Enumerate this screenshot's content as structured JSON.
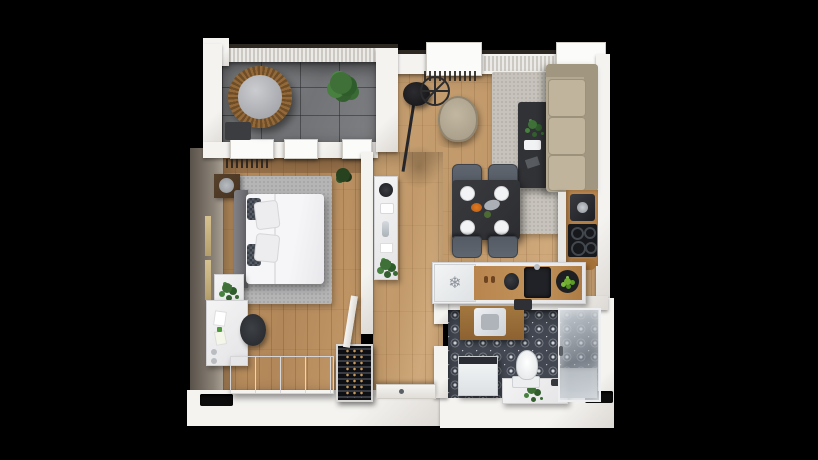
{
  "scene": {
    "type": "3d-apartment-floor-plan-top-view",
    "visible_text": "none"
  },
  "colors": {
    "background": "#000000",
    "wall": "#f4f3f0",
    "wall_shade": "#ddd9d4",
    "wall_cap": "#2e2823",
    "wall_face_left": "#8a8176",
    "wood": "#c59e70",
    "wood_dark": "#bb905f",
    "walnut": "#7c5a38",
    "balcony_tile": "#717376",
    "rug_living": "#c7c3bc",
    "rug_bedroom": "#b5b5b6",
    "sofa": "#b3a891",
    "sofa_cushion": "#c0b49d",
    "charcoal": "#313236",
    "chair_gray": "#555b64",
    "counter_wood": "#b8854d",
    "appliance_black": "#17181c",
    "bath_tile": "#424751",
    "shower_glass": "#ccd3d8",
    "plant": "#3a6b35",
    "rattan": "#93693a",
    "cushion_gray": "#9b9ca1",
    "fruit_green": "#6fae2f",
    "amber": "#c89858"
  },
  "icons": [
    {
      "name": "snowflake-icon",
      "glyph": "❄"
    }
  ],
  "rooms": [
    {
      "name": "balcony",
      "floor": "gray-tile",
      "items": [
        "hanging-egg-chair",
        "potted-plant",
        "doormat"
      ]
    },
    {
      "name": "living-dining-kitchen",
      "floor": "wood-plank",
      "items": [
        "arc-floor-lamp",
        "wheel-decor",
        "armchair",
        "area-rug",
        "coffee-table",
        "sofa",
        "dining-table",
        "dining-chairs-x4",
        "plates",
        "kitchen-counter",
        "coffee-machine",
        "cooktop",
        "cutting-board",
        "fridge",
        "kettle",
        "sink",
        "fruit-bowl",
        "salt-pepper-shakers"
      ]
    },
    {
      "name": "bedroom",
      "floor": "wood-plank",
      "items": [
        "double-bed",
        "headboard",
        "pillows",
        "rug",
        "nightstand-top",
        "nightstand-bottom",
        "desk",
        "desk-chair",
        "wardrobe",
        "mirrors",
        "plants",
        "radiator"
      ]
    },
    {
      "name": "hallway",
      "floor": "wood-plank",
      "items": [
        "sideboard",
        "wine-rack",
        "bedroom-door",
        "entry-door"
      ]
    },
    {
      "name": "bathroom",
      "floor": "patterned-tile",
      "items": [
        "vanity-with-sink",
        "washing-machine",
        "toilet",
        "bench-ledge",
        "shower-enclosure",
        "shower-tray",
        "plant"
      ]
    }
  ]
}
